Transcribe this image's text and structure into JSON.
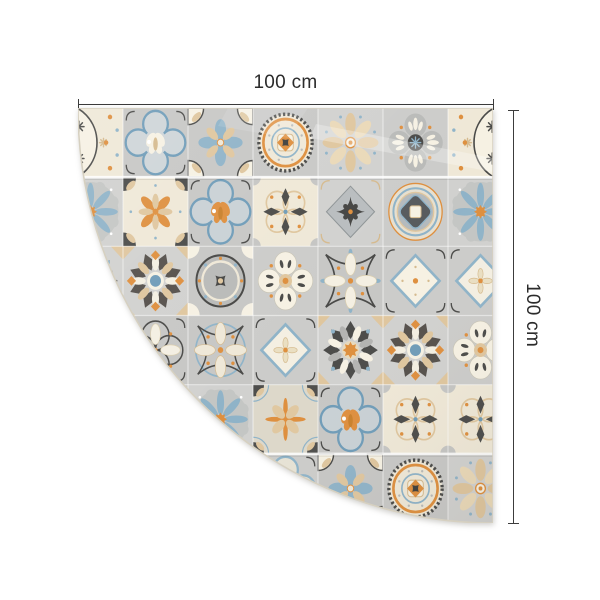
{
  "dimensions": {
    "width_label": "100 cm",
    "height_label": "100 cm",
    "line_color": "#3c3c3c"
  },
  "mat": {
    "shape": "quarter-circle",
    "radius_px": 415,
    "palette": {
      "bg1": "#c7c7c5",
      "bg2": "#d1d1cf",
      "bg3": "#ccccca",
      "cream": "#efe8d7",
      "cream2": "#f6f1e3",
      "tan": "#dfc69e",
      "tanD": "#d5ba8e",
      "orange": "#de8f3e",
      "orangeD": "#c9802c",
      "blue": "#8fb3c8",
      "blueD": "#6f9cb8",
      "blueGray": "#a9bcc8",
      "dark": "#4a4a48",
      "gray3": "#b9bab8",
      "grayBlue": "#b4babd",
      "grout": "rgba(255,255,255,0.5)",
      "seam": "rgba(255,255,255,0.85)",
      "edge": "#d6d0c0"
    },
    "grid": {
      "cols": 7,
      "rows": 6,
      "tile_w": 65,
      "tile_h": 69.17,
      "offset_x": -20,
      "map": [
        [
          "cas_l",
          "qf_cream",
          "fcb",
          "mt",
          "bf8",
          "cq4_blue",
          "cas_r"
        ],
        [
          "bfl",
          "olc",
          "qf_orange",
          "pcd",
          "dia_dark",
          "rm",
          "bfl"
        ],
        [
          "sr_orange",
          "sr_blue",
          "circ",
          "cq4_beige",
          "lc_white",
          "dia_blue",
          "dia_cream"
        ],
        [
          "cq4_blue",
          "lc_dark",
          "lc_blue",
          "dia_cream",
          "sr_orange",
          "sr_blue",
          "cq4_beige"
        ],
        [
          "bf8",
          "mt",
          "bfl",
          "tan",
          "qf_orange",
          "pcd",
          "pcd"
        ],
        [
          "lc_dark",
          "bfl",
          "lc_blue",
          "qf_beige",
          "fcb",
          "mt",
          "bf8"
        ]
      ]
    }
  }
}
